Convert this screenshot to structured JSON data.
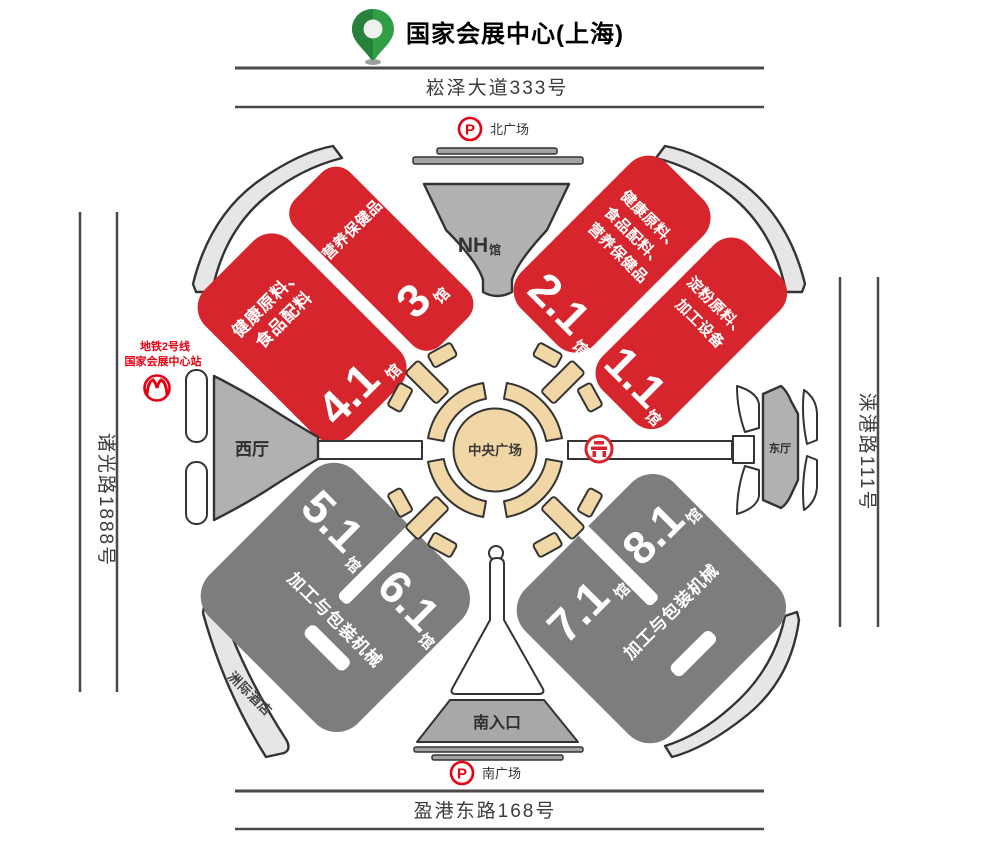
{
  "title": {
    "text": "国家会展中心(上海)"
  },
  "roads": {
    "north": "崧泽大道333号",
    "south": "盈港东路168号",
    "west": "诸光路1888号",
    "east": "涞港路111号"
  },
  "plazas": {
    "north": {
      "parking": "P",
      "label": "北广场"
    },
    "south": {
      "parking": "P",
      "label": "南广场"
    }
  },
  "metro": {
    "line1": "地铁2号线",
    "line2": "国家会展中心站"
  },
  "center_plaza": {
    "label": "中央广场"
  },
  "entrances": {
    "nh": {
      "name": "NH",
      "suffix": "馆"
    },
    "west": {
      "label": "西厅"
    },
    "east": {
      "label": "东厅"
    },
    "south": {
      "label": "南入口"
    }
  },
  "hotel": {
    "label": "洲际酒店"
  },
  "halls": {
    "red": [
      {
        "number": "4.1",
        "suffix": "馆",
        "lines": [
          "健康原料、",
          "食品配料"
        ]
      },
      {
        "number": "3",
        "suffix": "馆",
        "lines": [
          "营养保健品"
        ]
      },
      {
        "number": "2.1",
        "suffix": "馆",
        "lines": [
          "健康原料、",
          "食品配料、",
          "营养保健品"
        ]
      },
      {
        "number": "1.1",
        "suffix": "馆",
        "lines": [
          "淀粉原料、",
          "加工设备"
        ]
      }
    ],
    "gray": [
      {
        "number": "5.1",
        "suffix": "馆"
      },
      {
        "number": "6.1",
        "suffix": "馆"
      },
      {
        "number": "7.1",
        "suffix": "馆"
      },
      {
        "number": "8.1",
        "suffix": "馆"
      }
    ],
    "gray_categories": {
      "southwest": "加工与包装机械",
      "southeast": "加工与包装机械"
    }
  },
  "colors": {
    "hall_red": "#d6252c",
    "hall_gray": "#7d7d7d",
    "accent_red": "#e60012",
    "tan": "#f2d7a6",
    "pin_green": "#2f9e45"
  }
}
